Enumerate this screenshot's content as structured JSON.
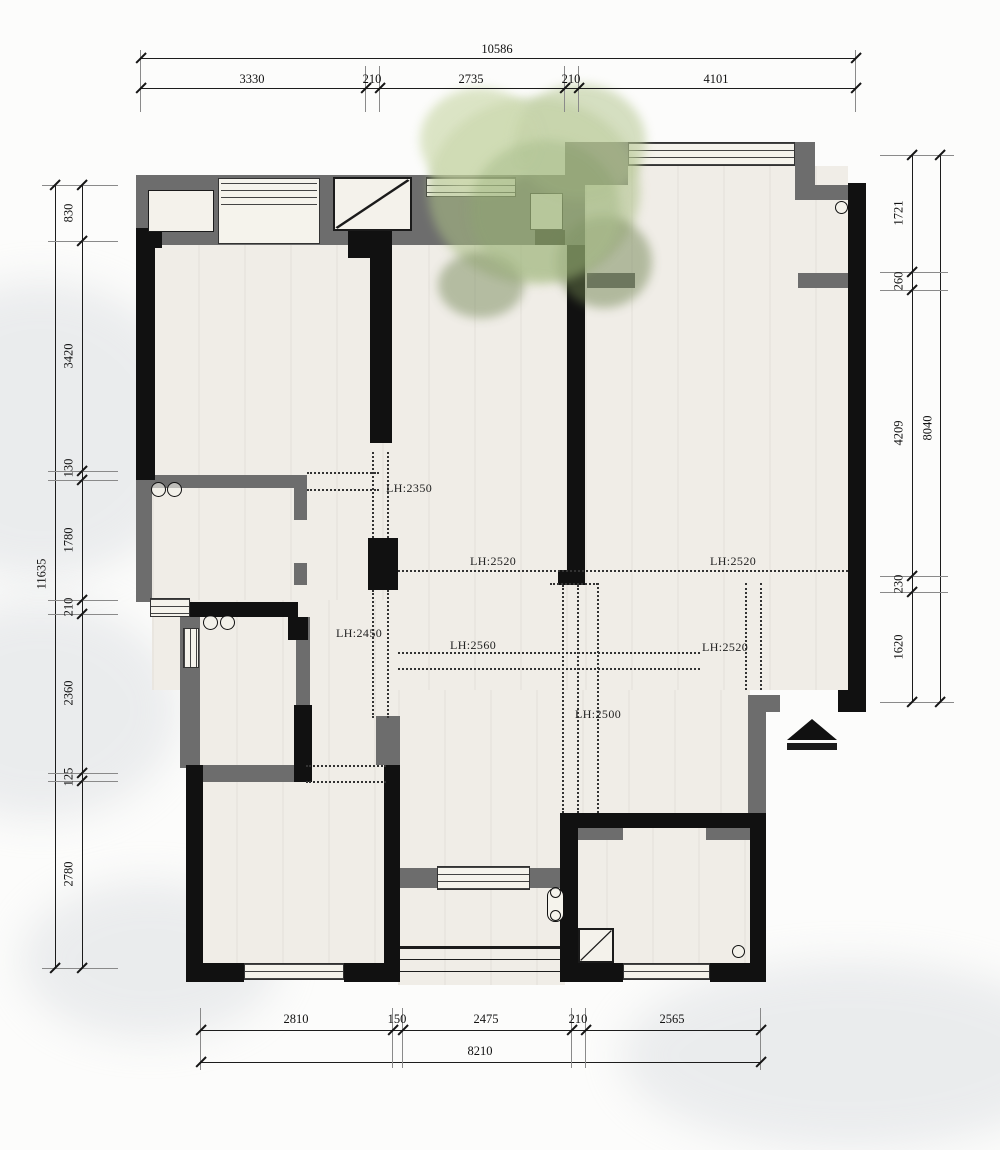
{
  "drawing": {
    "type": "residential floor plan"
  },
  "dimensions": {
    "top": {
      "total": "10586",
      "segments": [
        "3330",
        "210",
        "2735",
        "210",
        "4101"
      ]
    },
    "left": {
      "total": "11635",
      "segments": [
        "830",
        "3420",
        "130",
        "1780",
        "210",
        "2360",
        "125",
        "2780"
      ]
    },
    "right": {
      "total": "8040",
      "segments": [
        "1721",
        "260",
        "4209",
        "230",
        "1620"
      ]
    },
    "bottom": {
      "total": "8210",
      "segments": [
        "2810",
        "150",
        "2475",
        "210",
        "2565"
      ]
    }
  },
  "ceiling_labels": {
    "a": "LH:2350",
    "b": "LH:2520",
    "c": "LH:2520",
    "d": "LH:2450",
    "e": "LH:2560",
    "f": "LH:2520",
    "g": "LH:2500"
  },
  "colors": {
    "wall_black": "#111111",
    "wall_gray": "#6d6d6d",
    "floor": "#f0ede7",
    "tree_green": "#abbf86"
  }
}
